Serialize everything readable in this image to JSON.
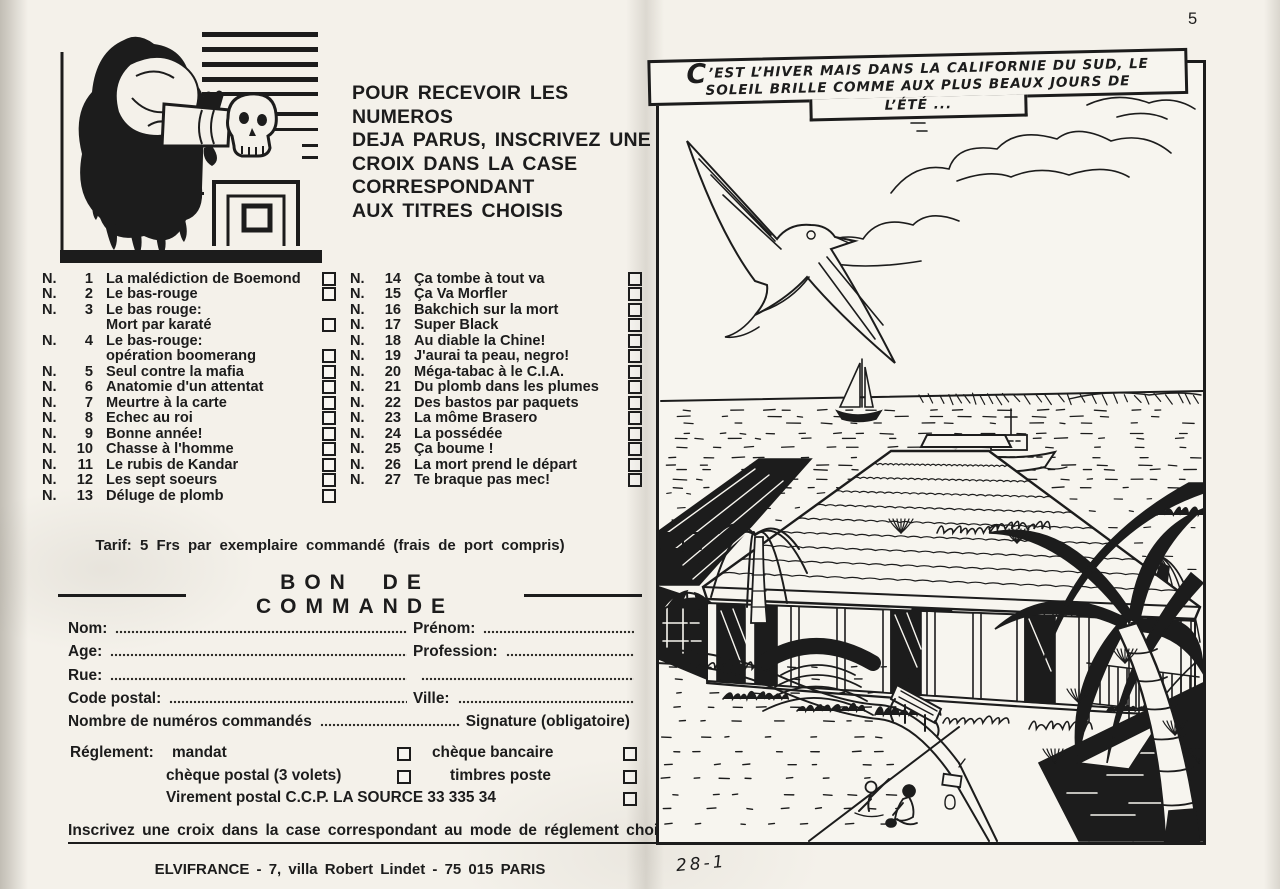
{
  "colors": {
    "ink": "#1c1c1c",
    "paper": "#f4f1ea",
    "panel_paper": "#f7f5ef"
  },
  "page": {
    "number": "5",
    "panel_code": "28-1"
  },
  "left_page": {
    "instructions_lines": [
      "POUR RECEVOIR LES NUMEROS",
      "DEJA PARUS, INSCRIVEZ UNE",
      "CROIX DANS LA CASE",
      "CORRESPONDANT",
      "AUX TITRES CHOISIS"
    ],
    "catalog": {
      "numbering_prefix": "N.",
      "col1": [
        {
          "num": "1",
          "lines": [
            "La malédiction de Boemond"
          ]
        },
        {
          "num": "2",
          "lines": [
            "Le bas-rouge"
          ]
        },
        {
          "num": "3",
          "lines": [
            "Le bas rouge:",
            "Mort par karaté"
          ]
        },
        {
          "num": "4",
          "lines": [
            "Le bas-rouge:",
            "opération boomerang"
          ]
        },
        {
          "num": "5",
          "lines": [
            "Seul contre la mafia"
          ]
        },
        {
          "num": "6",
          "lines": [
            "Anatomie d'un attentat"
          ]
        },
        {
          "num": "7",
          "lines": [
            "Meurtre à la carte"
          ]
        },
        {
          "num": "8",
          "lines": [
            "Echec au roi"
          ]
        },
        {
          "num": "9",
          "lines": [
            "Bonne année!"
          ]
        },
        {
          "num": "10",
          "lines": [
            "Chasse à l'homme"
          ]
        },
        {
          "num": "11",
          "lines": [
            "Le rubis de Kandar"
          ]
        },
        {
          "num": "12",
          "lines": [
            "Les sept soeurs"
          ]
        },
        {
          "num": "13",
          "lines": [
            "Déluge de plomb"
          ]
        }
      ],
      "col2": [
        {
          "num": "14",
          "lines": [
            "Ça tombe à tout va"
          ]
        },
        {
          "num": "15",
          "lines": [
            "Ça Va Morfler"
          ]
        },
        {
          "num": "16",
          "lines": [
            "Bakchich sur la mort"
          ]
        },
        {
          "num": "17",
          "lines": [
            "Super Black"
          ]
        },
        {
          "num": "18",
          "lines": [
            "Au diable la Chine!"
          ]
        },
        {
          "num": "19",
          "lines": [
            "J'aurai ta peau, negro!"
          ]
        },
        {
          "num": "20",
          "lines": [
            "Méga-tabac à le C.I.A."
          ]
        },
        {
          "num": "21",
          "lines": [
            "Du plomb dans les plumes"
          ]
        },
        {
          "num": "22",
          "lines": [
            "Des bastos par paquets"
          ]
        },
        {
          "num": "23",
          "lines": [
            "La môme Brasero"
          ]
        },
        {
          "num": "24",
          "lines": [
            "La possédée"
          ]
        },
        {
          "num": "25",
          "lines": [
            "Ça boume !"
          ]
        },
        {
          "num": "26",
          "lines": [
            "La mort prend le départ"
          ]
        },
        {
          "num": "27",
          "lines": [
            "Te braque pas mec!"
          ]
        }
      ]
    },
    "tarif": "Tarif: 5 Frs par exemplaire commandé (frais de port compris)",
    "order_form": {
      "title": "BON DE COMMANDE",
      "labels": {
        "nom": "Nom:",
        "prenom": "Prénom:",
        "age": "Age:",
        "profession": "Profession:",
        "rue": "Rue:",
        "code_postal": "Code postal:",
        "ville": "Ville:",
        "nombre": "Nombre de numéros commandés",
        "signature": "Signature  (obligatoire)"
      }
    },
    "payment": {
      "label": "Réglement:",
      "options": [
        "mandat",
        "chèque bancaire",
        "chèque postal  (3 volets)",
        "timbres poste",
        "Virement postal  C.C.P.  LA SOURCE  33 335 34"
      ]
    },
    "note": "Inscrivez une croix dans la case correspondant au mode de réglement choisi.",
    "publisher": "ELVIFRANCE  -  7,  villa Robert Lindet  -  75 015  PARIS"
  },
  "right_page": {
    "caption": {
      "initial": "C",
      "line1_rest": "’EST L’HIVER MAIS DANS LA CALIFORNIE DU SUD, LE",
      "line2": "SOLEIL BRILLE COMME AUX PLUS BEAUX JOURS DE",
      "line3": "L’ÉTÉ ..."
    },
    "scene_description": "seaside villa with pool, palm trees, seagull, sailboat and motorboat"
  }
}
